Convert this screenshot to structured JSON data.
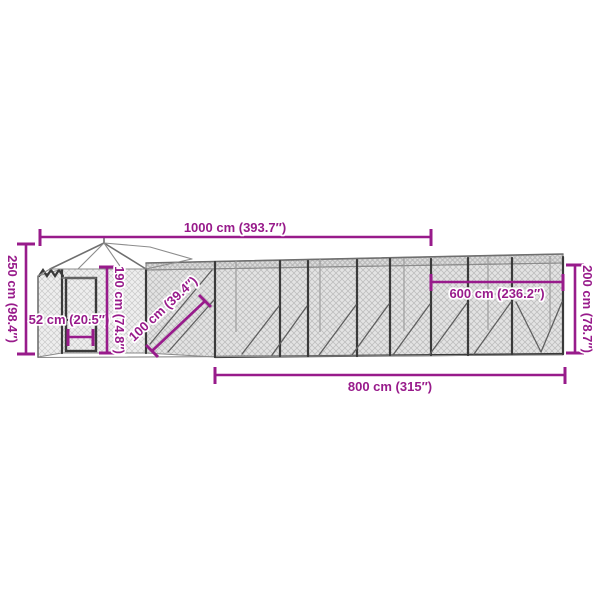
{
  "diagram": {
    "type": "product-dimension-diagram",
    "subject": "outdoor-chicken-run-with-coop-roof",
    "colors": {
      "dimension_accent": "#981b8b",
      "label_halo": "#ffffff",
      "frame_dark": "#3a3a3a",
      "mesh_line": "#c6c6c6",
      "background": "#ffffff"
    },
    "dimensions": {
      "total_length": {
        "value_cm": 1000,
        "value_in": 393.7,
        "label": "1000 cm (393.7″)"
      },
      "total_height": {
        "value_cm": 250,
        "value_in": 98.4,
        "label": "250 cm (98.4″)"
      },
      "door_width": {
        "value_cm": 52,
        "value_in": 20.5,
        "label": "52 cm (20.5″)"
      },
      "coop_height": {
        "value_cm": 190,
        "value_in": 74.8,
        "label": "190 cm (74.8″)"
      },
      "run_width": {
        "value_cm": 100,
        "value_in": 39.4,
        "label": "100 cm (39.4″)"
      },
      "covered_length": {
        "value_cm": 600,
        "value_in": 236.2,
        "label": "600 cm (236.2″)"
      },
      "run_height": {
        "value_cm": 200,
        "value_in": 78.7,
        "label": "200 cm (78.7″)"
      },
      "run_length": {
        "value_cm": 800,
        "value_in": 315,
        "label": "800 cm (315″)"
      }
    }
  }
}
